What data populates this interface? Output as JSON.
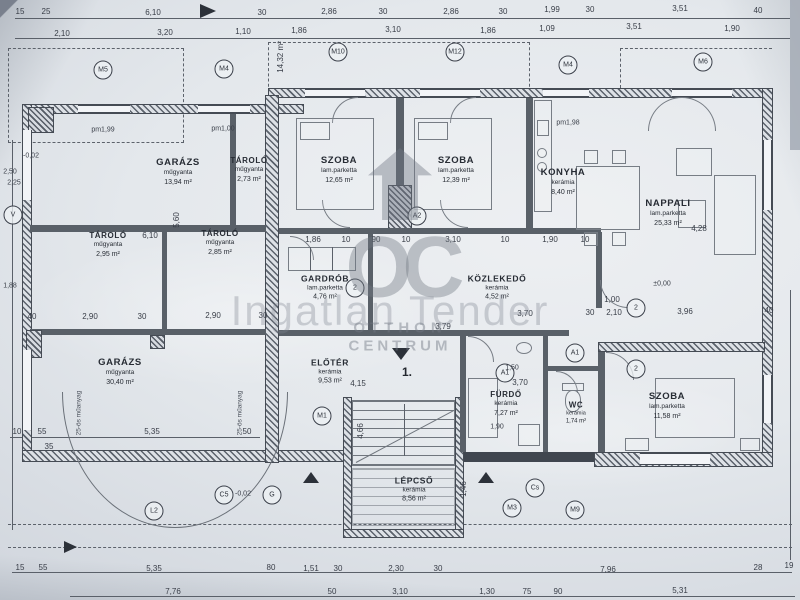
{
  "watermark": {
    "logo_initials": "OC",
    "brand_line1": "OTTHON",
    "brand_line2": "CENTRUM",
    "banner": "Ingatlan Tender"
  },
  "unit_number": "1.",
  "rooms": [
    {
      "name": "GARÁZS",
      "mat": "műgyanta",
      "area": "13,94 m²"
    },
    {
      "name": "TÁROLÓ",
      "mat": "műgyanta",
      "area": "2,73 m²"
    },
    {
      "name": "SZOBA",
      "mat": "lam.parketta",
      "area": "12,65 m²"
    },
    {
      "name": "SZOBA",
      "mat": "lam.parketta",
      "area": "12,39 m²"
    },
    {
      "name": "KONYHA",
      "mat": "kerámia",
      "area": "8,40 m²"
    },
    {
      "name": "NAPPALI",
      "mat": "lam.parketta",
      "area": "25,33 m²"
    },
    {
      "name": "TÁROLÓ",
      "mat": "műgyanta",
      "area": "2,95 m²"
    },
    {
      "name": "TÁROLÓ",
      "mat": "műgyanta",
      "area": "2,85 m²"
    },
    {
      "name": "GARDRÓB",
      "mat": "lam.parketta",
      "area": "4,76 m²"
    },
    {
      "name": "KÖZLEKEDŐ",
      "mat": "kerámia",
      "area": "4,52 m²"
    },
    {
      "name": "GARÁZS",
      "mat": "műgyanta",
      "area": "30,40 m²"
    },
    {
      "name": "ELŐTÉR",
      "mat": "kerámia",
      "area": "9,53 m²"
    },
    {
      "name": "FÜRDŐ",
      "mat": "kerámia",
      "area": "7,27 m²"
    },
    {
      "name": "WC",
      "mat": "kerámia",
      "area": "1,74 m²"
    },
    {
      "name": "SZOBA",
      "mat": "lam.parketta",
      "area": "11,58 m²"
    },
    {
      "name": "LÉPCSŐ",
      "mat": "kerámia",
      "area": "8,56 m²"
    }
  ],
  "markers": [
    "M5",
    "M4",
    "M10",
    "M12",
    "M4",
    "M6",
    "V",
    "A2",
    "2",
    "2",
    "2",
    "A1",
    "A1",
    "M1",
    "G",
    "M3",
    "C5",
    "L2",
    "Cs",
    "M9"
  ],
  "dims": {
    "top1": [
      "15",
      "25",
      "6,10",
      "30",
      "2,86",
      "30",
      "2,86",
      "30",
      "1,99",
      "30",
      "3,51",
      "40"
    ],
    "top2": [
      "2,10",
      "3,20",
      "1,10",
      "1,86",
      "3,10",
      "1,86",
      "1,09",
      "3,51",
      "1,90"
    ],
    "row3": [
      "6,10",
      "1,86",
      "10",
      "90",
      "10",
      "3,10",
      "10",
      "1,90",
      "10",
      "4,28"
    ],
    "mid": [
      "40",
      "2,90",
      "30",
      "2,90",
      "30",
      "3,70",
      "30",
      "1,00",
      "2,10",
      "3,96",
      "40"
    ],
    "entry": [
      "4,15",
      "3,70",
      "1,50",
      "1,90",
      "5,35",
      "50",
      "10",
      "55",
      "35",
      "3,79"
    ],
    "bottom1": [
      "15",
      "55",
      "5,35",
      "80",
      "1,51",
      "30",
      "2,30",
      "30",
      "7,96",
      "28",
      "19"
    ],
    "bottom2": [
      "7,76",
      "50",
      "3,10",
      "1,30",
      "75",
      "90",
      "5,31"
    ],
    "vert": [
      "14,32 m²",
      "5,60",
      "4,66",
      "1,46",
      "2,50",
      "2,25",
      "1,88"
    ]
  },
  "annotations": {
    "pm_a": "pm1,99",
    "pm_b": "pm1,00",
    "pm_c": "pm1,98",
    "level_zero": "±0,00",
    "level_a": "-0,02",
    "level_b": "-0,02",
    "pipe_a": "25-ös műanyag",
    "pipe_b": "25-ös műanyag"
  }
}
